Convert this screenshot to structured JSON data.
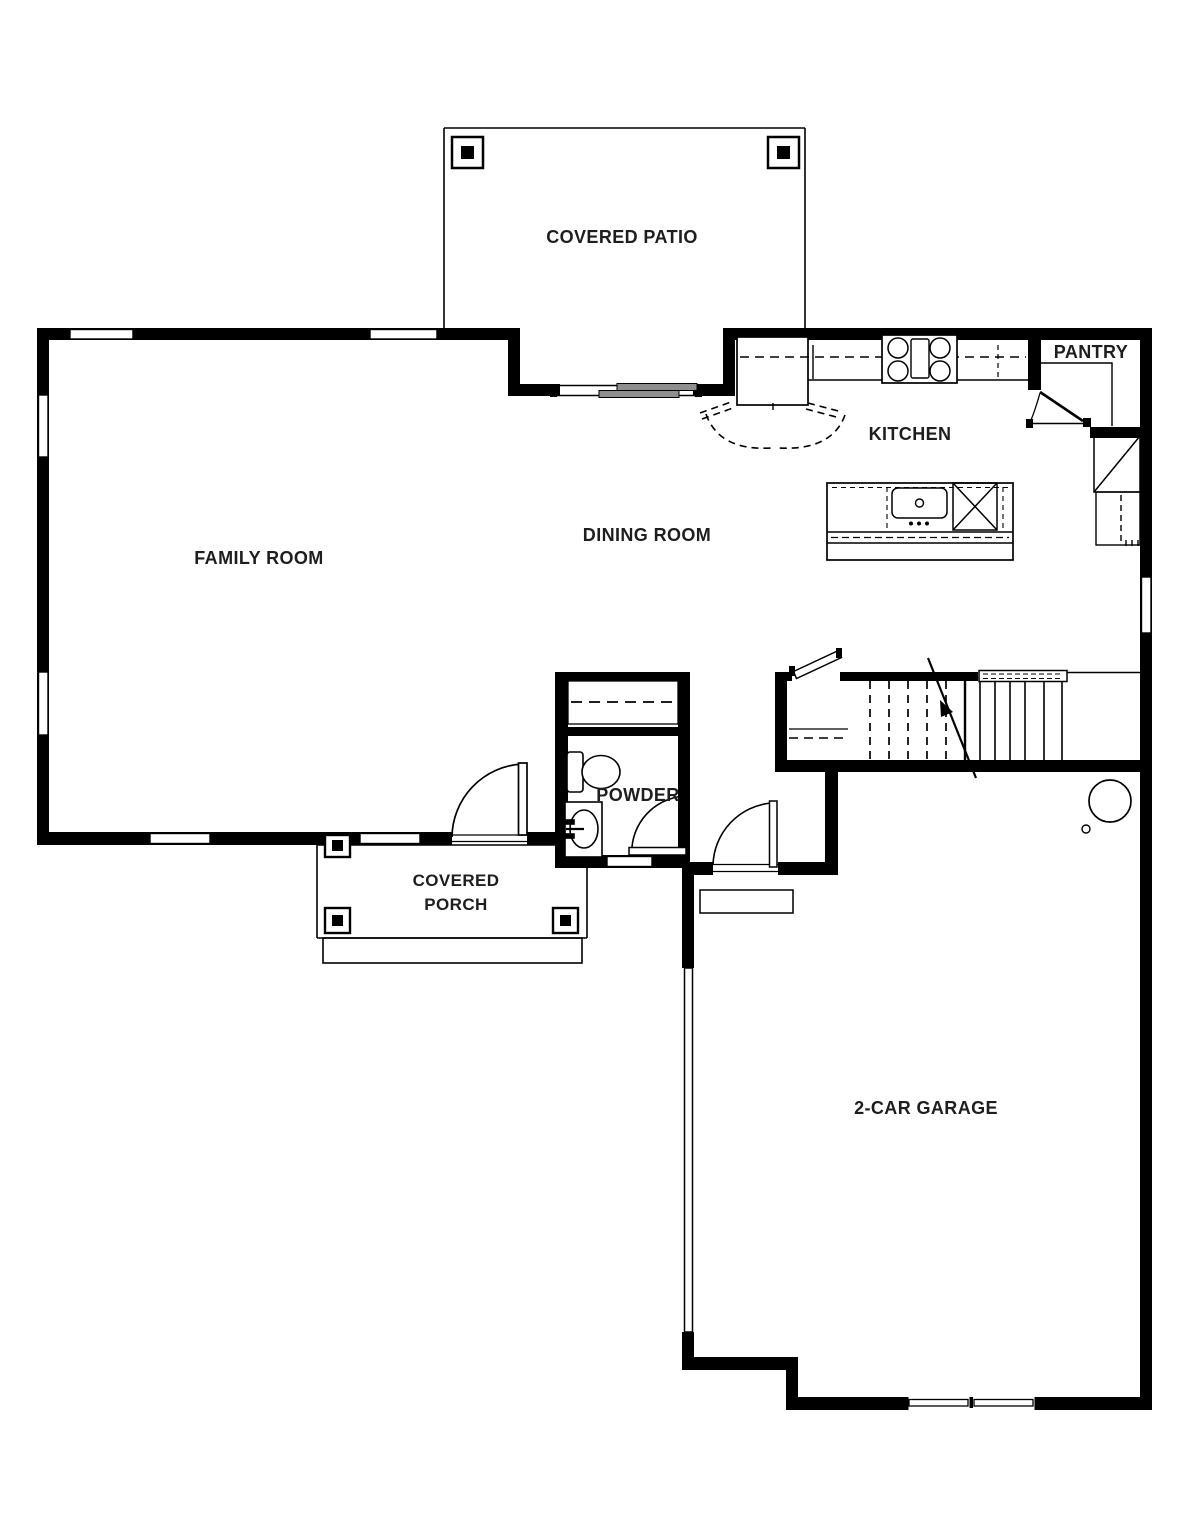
{
  "labels": {
    "covered_patio": "COVERED PATIO",
    "pantry": "PANTRY",
    "kitchen": "KITCHEN",
    "dining_room": "DINING ROOM",
    "family_room": "FAMILY ROOM",
    "powder": "POWDER",
    "covered_porch_line1": "COVERED",
    "covered_porch_line2": "PORCH",
    "garage": "2-CAR GARAGE"
  },
  "colors": {
    "wall_line": "#000000",
    "label_text": "#1e1e1e",
    "background": "#ffffff",
    "sliding_door_fill": "#8e8e8e"
  }
}
